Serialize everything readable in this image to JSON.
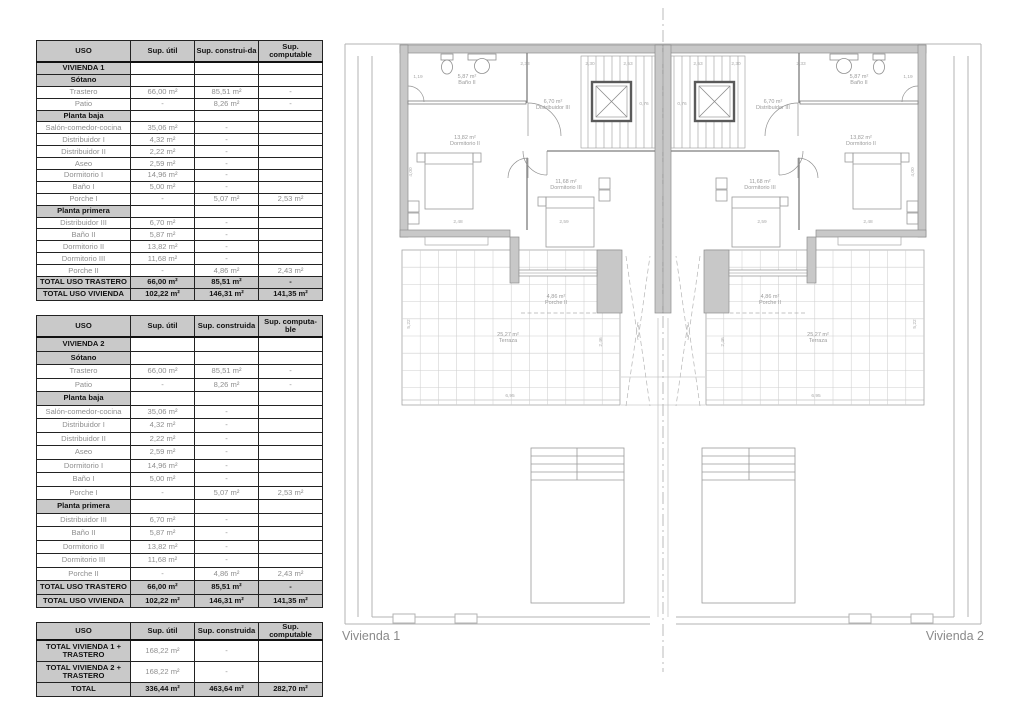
{
  "colors": {
    "table_header_fill": "#c9c9c9",
    "table_border": "#111111",
    "muted_text": "#8f8f8f",
    "wall_fill": "#c8c8c8",
    "plan_line": "#9a9a9a"
  },
  "tables": [
    {
      "title": "Vivienda 1 areas",
      "headers": [
        "USO",
        "Sup. útil",
        "Sup. construi-da",
        "Sup. computable"
      ],
      "rows": [
        {
          "l": "VIVIENDA 1",
          "v": [
            "",
            "",
            ""
          ],
          "t": "b"
        },
        {
          "l": "Sótano",
          "v": [
            "",
            "",
            ""
          ],
          "t": "s"
        },
        {
          "l": "Trastero",
          "v": [
            "66,00 m²",
            "85,51 m²",
            "-"
          ],
          "t": "d"
        },
        {
          "l": "Patio",
          "v": [
            "-",
            "8,26 m²",
            "-"
          ],
          "t": "d"
        },
        {
          "l": "Planta baja",
          "v": [
            "",
            "",
            ""
          ],
          "t": "s"
        },
        {
          "l": "Salón-comedor-cocina",
          "v": [
            "35,06 m²",
            "-",
            ""
          ],
          "t": "d"
        },
        {
          "l": "Distribuidor I",
          "v": [
            "4,32 m²",
            "-",
            ""
          ],
          "t": "d"
        },
        {
          "l": "Distribuidor II",
          "v": [
            "2,22 m²",
            "-",
            ""
          ],
          "t": "d"
        },
        {
          "l": "Aseo",
          "v": [
            "2,59 m²",
            "-",
            ""
          ],
          "t": "d"
        },
        {
          "l": "Dormitorio I",
          "v": [
            "14,96 m²",
            "-",
            ""
          ],
          "t": "d"
        },
        {
          "l": "Baño I",
          "v": [
            "5,00 m²",
            "-",
            ""
          ],
          "t": "d"
        },
        {
          "l": "Porche I",
          "v": [
            "-",
            "5,07 m²",
            "2,53 m²"
          ],
          "t": "d"
        },
        {
          "l": "Planta primera",
          "v": [
            "",
            "",
            ""
          ],
          "t": "s"
        },
        {
          "l": "Distribuidor III",
          "v": [
            "6,70 m²",
            "-",
            ""
          ],
          "t": "d"
        },
        {
          "l": "Baño II",
          "v": [
            "5,87 m²",
            "-",
            ""
          ],
          "t": "d"
        },
        {
          "l": "Dormitorio II",
          "v": [
            "13,82 m²",
            "-",
            ""
          ],
          "t": "d"
        },
        {
          "l": "Dormitorio III",
          "v": [
            "11,68 m²",
            "-",
            ""
          ],
          "t": "d"
        },
        {
          "l": "Porche II",
          "v": [
            "-",
            "4,86 m²",
            "2,43 m²"
          ],
          "t": "d"
        },
        {
          "l": "TOTAL USO TRASTERO",
          "v": [
            "66,00 m²",
            "85,51 m²",
            "-"
          ],
          "t": "t"
        },
        {
          "l": "TOTAL USO VIVIENDA",
          "v": [
            "102,22 m²",
            "146,31 m²",
            "141,35 m²"
          ],
          "t": "t"
        }
      ]
    },
    {
      "title": "Vivienda 2 areas",
      "headers": [
        "USO",
        "Sup. útil",
        "Sup. construida",
        "Sup. computa-ble"
      ],
      "rows": [
        {
          "l": "VIVIENDA 2",
          "v": [
            "",
            "",
            ""
          ],
          "t": "b"
        },
        {
          "l": "Sótano",
          "v": [
            "",
            "",
            ""
          ],
          "t": "s"
        },
        {
          "l": "Trastero",
          "v": [
            "66,00 m²",
            "85,51 m²",
            "-"
          ],
          "t": "d"
        },
        {
          "l": "Patio",
          "v": [
            "-",
            "8,26 m²",
            "-"
          ],
          "t": "d"
        },
        {
          "l": "Planta baja",
          "v": [
            "",
            "",
            ""
          ],
          "t": "s"
        },
        {
          "l": "Salón-comedor-cocina",
          "v": [
            "35,06 m²",
            "-",
            ""
          ],
          "t": "d"
        },
        {
          "l": "Distribuidor I",
          "v": [
            "4,32 m²",
            "-",
            ""
          ],
          "t": "d"
        },
        {
          "l": "Distribuidor II",
          "v": [
            "2,22 m²",
            "-",
            ""
          ],
          "t": "d"
        },
        {
          "l": "Aseo",
          "v": [
            "2,59 m²",
            "-",
            ""
          ],
          "t": "d"
        },
        {
          "l": "Dormitorio I",
          "v": [
            "14,96 m²",
            "-",
            ""
          ],
          "t": "d"
        },
        {
          "l": "Baño I",
          "v": [
            "5,00 m²",
            "-",
            ""
          ],
          "t": "d"
        },
        {
          "l": "Porche I",
          "v": [
            "-",
            "5,07 m²",
            "2,53 m²"
          ],
          "t": "d"
        },
        {
          "l": "Planta primera",
          "v": [
            "",
            "",
            ""
          ],
          "t": "s"
        },
        {
          "l": "Distribuidor III",
          "v": [
            "6,70 m²",
            "-",
            ""
          ],
          "t": "d"
        },
        {
          "l": "Baño II",
          "v": [
            "5,87 m²",
            "-",
            ""
          ],
          "t": "d"
        },
        {
          "l": "Dormitorio II",
          "v": [
            "13,82 m²",
            "-",
            ""
          ],
          "t": "d"
        },
        {
          "l": "Dormitorio III",
          "v": [
            "11,68 m²",
            "-",
            ""
          ],
          "t": "d"
        },
        {
          "l": "Porche II",
          "v": [
            "-",
            "4,86 m²",
            "2,43 m²"
          ],
          "t": "d"
        },
        {
          "l": "TOTAL USO TRASTERO",
          "v": [
            "66,00 m²",
            "85,51 m²",
            "-"
          ],
          "t": "t"
        },
        {
          "l": "TOTAL USO VIVIENDA",
          "v": [
            "102,22 m²",
            "146,31 m²",
            "141,35 m²"
          ],
          "t": "t"
        }
      ]
    },
    {
      "title": "Totals",
      "headers": [
        "USO",
        "Sup. útil",
        "Sup. construida",
        "Sup. computable"
      ],
      "rows": [
        {
          "l": "TOTAL VIVIENDA 1 + TRASTERO",
          "v": [
            "168,22 m²",
            "-",
            ""
          ],
          "t": "dt"
        },
        {
          "l": "TOTAL VIVIENDA 2 + TRASTERO",
          "v": [
            "168,22 m²",
            "-",
            ""
          ],
          "t": "dt"
        },
        {
          "l": "TOTAL",
          "v": [
            "336,44 m²",
            "463,64 m²",
            "282,70 m²"
          ],
          "t": "t"
        }
      ]
    }
  ],
  "plan": {
    "vivienda1_label": "Vivienda 1",
    "vivienda2_label": "Vivienda 2",
    "rooms": [
      {
        "area": "5,87 m²",
        "name": "Baño II",
        "x": 129,
        "y": 70
      },
      {
        "area": "6,70 m²",
        "name": "Distribuidor III",
        "x": 215,
        "y": 95
      },
      {
        "area": "13,82 m²",
        "name": "Dormitorio II",
        "x": 127,
        "y": 131
      },
      {
        "area": "11,68 m²",
        "name": "Dormitorio III",
        "x": 228,
        "y": 175
      },
      {
        "area": "4,86 m²",
        "name": "Porche II",
        "x": 218,
        "y": 290
      },
      {
        "area": "25,27 m²",
        "name": "Terraza",
        "x": 170,
        "y": 328
      }
    ],
    "dims": [
      {
        "t": "2,33",
        "x": 187,
        "y": 57
      },
      {
        "t": "2,30",
        "x": 252,
        "y": 57
      },
      {
        "t": "2,53",
        "x": 290,
        "y": 57
      },
      {
        "t": "1,19",
        "x": 80,
        "y": 70
      },
      {
        "t": "4,00",
        "x": 74,
        "y": 164,
        "rot": 1
      },
      {
        "t": "2,48",
        "x": 120,
        "y": 215
      },
      {
        "t": "2,59",
        "x": 226,
        "y": 215
      },
      {
        "t": "0,76",
        "x": 306,
        "y": 97
      },
      {
        "t": "5,22",
        "x": 72,
        "y": 316,
        "rot": 1
      },
      {
        "t": "2,46",
        "x": 264,
        "y": 334,
        "rot": 1
      },
      {
        "t": "6,95",
        "x": 172,
        "y": 389
      }
    ]
  }
}
